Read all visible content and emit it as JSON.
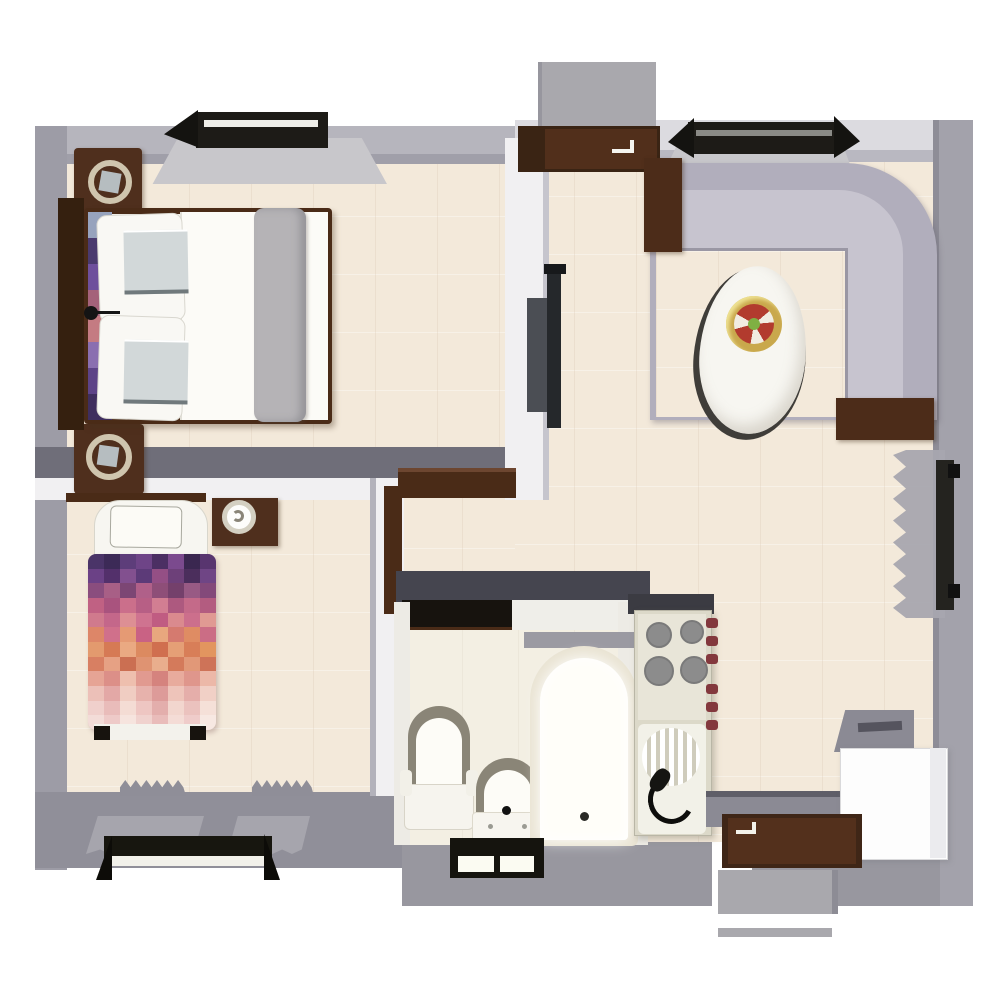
{
  "scene": {
    "type": "3d-floor-plan-top-view",
    "rooms": [
      "master-bedroom",
      "second-bedroom",
      "bathroom",
      "living-room",
      "kitchen",
      "entry"
    ]
  },
  "palette": {
    "floor": "#f3e9da",
    "bath_floor": "#f3efe3",
    "wall": "#9d9ca6",
    "wall_light": "#b6b5bd",
    "wall_lighter": "#dcdbe0",
    "wall_dark": "#6f6e79",
    "wall_navy": "#45454f",
    "wall_white": "#f1f0f2",
    "wood": "#4a2b17",
    "wood_dark": "#35200f",
    "sofa_back": "#b1aebc",
    "sofa_seat": "#c7c4cf",
    "curtain": "#a6a5ad",
    "frame_black": "#1d1b17",
    "porch": "#a9a8ad",
    "table_white": "#f7f6f1",
    "tv_dark": "#25282b",
    "kitchen_body": "#dcd9c9",
    "burner_gray": "#8c8c8c",
    "knob_red": "#83383d",
    "appliance_white": "#fdfdfd",
    "lamp_ring": "#cfc5ae",
    "bowl_gold": "#c9a84c",
    "bowl_red": "#b23b2e",
    "bowl_green": "#7fb043",
    "runner_gray": "#b5b3b6",
    "pillow_white": "#f9f8f4",
    "cushion_gray": "#d2d8d9"
  },
  "master_bedroom": {
    "furniture": [
      "double-bed",
      "headboard",
      "nightstand-lamp-top",
      "nightstand-lamp-bottom",
      "wall-sconce",
      "window-top"
    ],
    "bed_strip_colors": [
      "#97a3bd",
      "#4a3a6e",
      "#6e4f9c",
      "#a4627a",
      "#c47b82",
      "#8a6fb0",
      "#5d4387",
      "#3f2e5e"
    ]
  },
  "second_bedroom": {
    "furniture": [
      "single-bed",
      "pillow",
      "pixel-duvet",
      "nightstand-lamp",
      "door-leaf",
      "window-bottom-curtains"
    ],
    "duvet_pixels": [
      [
        "#4a3468",
        "#3c2a57",
        "#5d3d7a",
        "#6e4487",
        "#4b2f63",
        "#7b4a8e",
        "#3a2750",
        "#58356f"
      ],
      [
        "#6b4186",
        "#53306b",
        "#82508f",
        "#5c3a78",
        "#944f85",
        "#6d4079",
        "#4b2e5c",
        "#6f4585"
      ],
      [
        "#8a4d7e",
        "#a85f86",
        "#7c4674",
        "#b06089",
        "#8e4e78",
        "#74406b",
        "#985a84",
        "#83497a"
      ],
      [
        "#c06183",
        "#a9537e",
        "#cb6f8b",
        "#b75f85",
        "#d27e92",
        "#ad597f",
        "#c46a89",
        "#b35c80"
      ],
      [
        "#d07a8d",
        "#c4678a",
        "#dd8f94",
        "#cf7390",
        "#c05c82",
        "#da8a8e",
        "#cc6f8c",
        "#e09a93"
      ],
      [
        "#dd8668",
        "#d0708b",
        "#e59a74",
        "#c96284",
        "#e8a77e",
        "#d57a6f",
        "#df8c63",
        "#cb6d85"
      ],
      [
        "#e39a6e",
        "#d67a55",
        "#eaa982",
        "#dc8a60",
        "#d06f4f",
        "#e59f76",
        "#d87e58",
        "#e2955f"
      ],
      [
        "#d87f62",
        "#e6a184",
        "#cb6f52",
        "#df9372",
        "#e9ae8d",
        "#d47a5b",
        "#e19878",
        "#ce7358"
      ],
      [
        "#e6a495",
        "#dc8f88",
        "#eebfae",
        "#e19a90",
        "#d5837e",
        "#e8ab9d",
        "#df968c",
        "#ecb8a8"
      ],
      [
        "#ecc0b8",
        "#e3a8a6",
        "#f0cdc2",
        "#e7b2ac",
        "#dd9b99",
        "#eec4ba",
        "#e5aeaa",
        "#f1d0c6"
      ],
      [
        "#f0d0cc",
        "#e9bcba",
        "#f4dcd4",
        "#eec6c2",
        "#e3aeac",
        "#f2d6ce",
        "#ebc2be",
        "#f5e0d8"
      ],
      [
        "#f3dcd8",
        "#eecac8",
        "#f6e4de",
        "#f0d2ce",
        "#e9bcba",
        "#f4dcd6",
        "#efccca",
        "#f7e8e2"
      ]
    ]
  },
  "living_room": {
    "furniture": [
      "l-shaped-sofa",
      "end-table-left",
      "end-table-right",
      "teardrop-coffee-table",
      "decor-bowl",
      "wall-tv",
      "window-top",
      "window-right-curtain"
    ]
  },
  "bathroom": {
    "furniture": [
      "toilet",
      "pedestal-sink",
      "bathtub",
      "window-bottom",
      "door-opening"
    ]
  },
  "kitchen": {
    "furniture": [
      "kitchenette-column",
      "cooktop-4-burners",
      "sink-drainer",
      "faucet",
      "red-knobs",
      "half-wall",
      "appliance-box"
    ]
  },
  "entry": {
    "furniture": [
      "top-door-leaf",
      "top-porch",
      "bottom-door-leaf",
      "bottom-porch",
      "door-mat"
    ]
  }
}
